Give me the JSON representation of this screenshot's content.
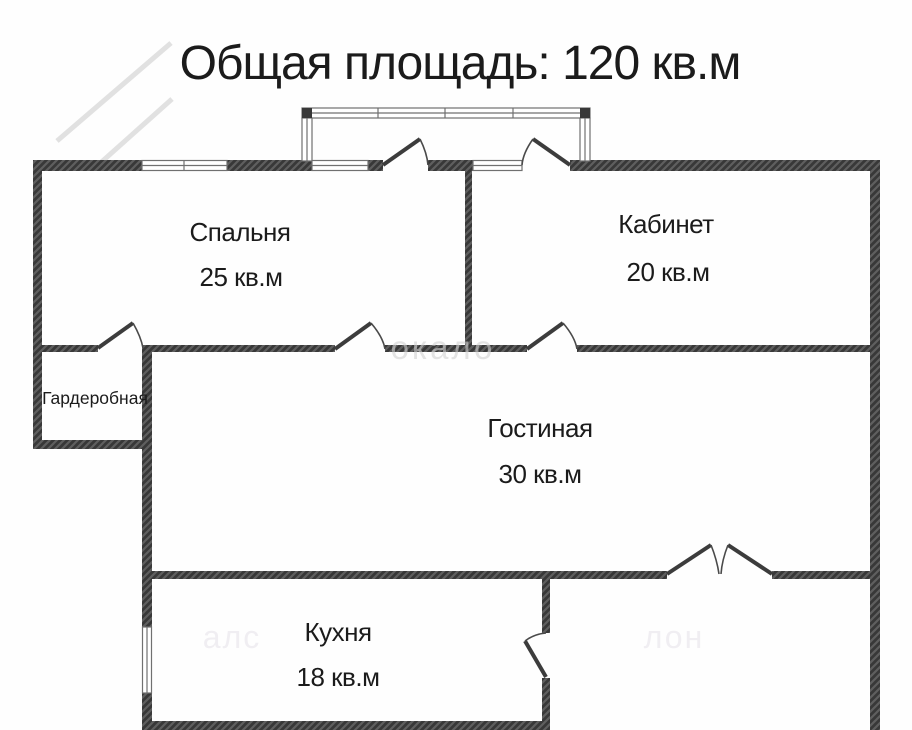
{
  "title": "Общая площадь: 120 кв.м",
  "rooms": {
    "bedroom": {
      "name": "Спальня",
      "area": "25 кв.м"
    },
    "office": {
      "name": "Кабинет",
      "area": "20 кв.м"
    },
    "wardrobe": {
      "name": "Гардеробная"
    },
    "living": {
      "name": "Гостиная",
      "area": "30 кв.м"
    },
    "kitchen": {
      "name": "Кухня",
      "area": "18 кв.м"
    }
  },
  "watermark": {
    "mid_fragment": "окало",
    "bottom_left_fragment": "алс",
    "bottom_right_fragment": "лон"
  },
  "colors": {
    "wall": "#383838",
    "wall_hatch": "#5f5f5f",
    "text": "#1b1b1b",
    "window_stroke": "#707070",
    "background": "#fefefe"
  }
}
